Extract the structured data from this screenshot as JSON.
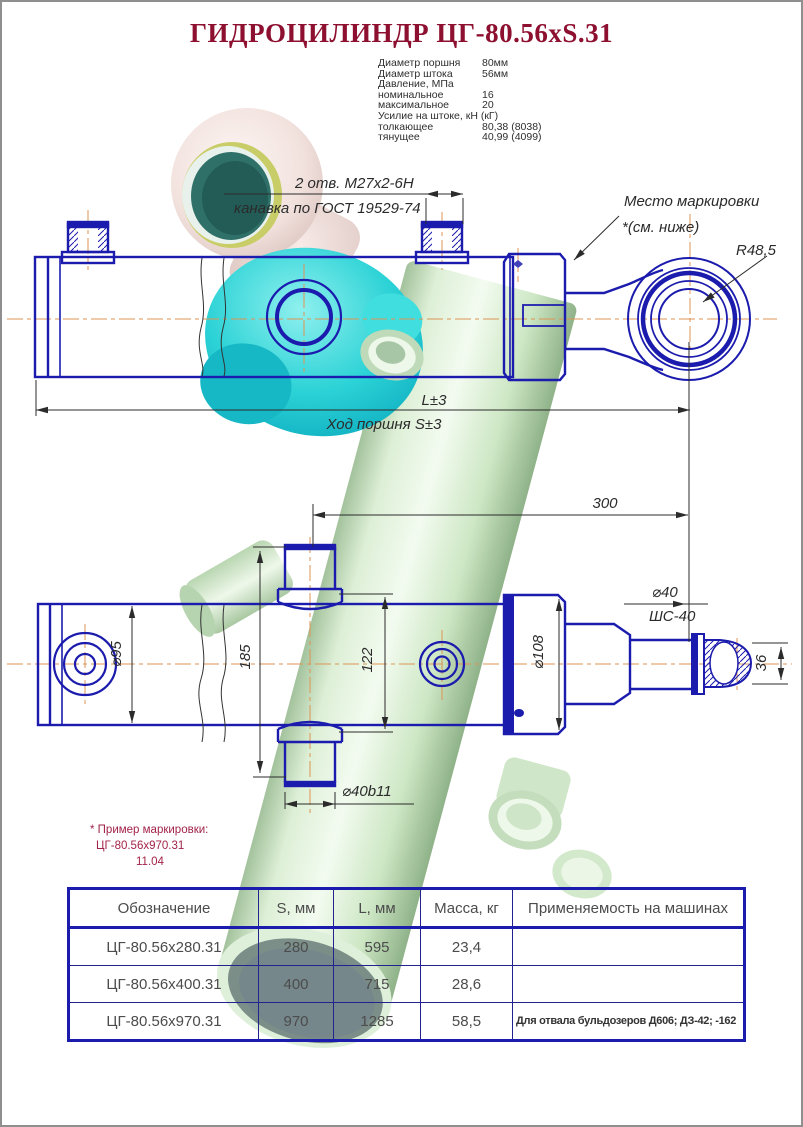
{
  "title": "ГИДРОЦИЛИНДР  ЦГ-80.56xS.31",
  "specs": {
    "rows": [
      {
        "label": "Диаметр поршня",
        "value": "80мм"
      },
      {
        "label": "Диаметр штока",
        "value": "56мм"
      },
      {
        "label": "Давление, МПа",
        "value": ""
      },
      {
        "label": "номинальное",
        "value": "16"
      },
      {
        "label": "максимальное",
        "value": "20"
      },
      {
        "label": "Усилие на штоке, кН (кГ)",
        "value": ""
      },
      {
        "label": "толкающее",
        "value": "80,38 (8038)"
      },
      {
        "label": "тянущее",
        "value": "40,99 (4099)"
      }
    ]
  },
  "annotations": {
    "holes": "2 отв. М27х2-6Н",
    "groove": "канавка по ГОСТ 19529-74",
    "marking_place": "Место маркировки",
    "marking_see_below": "*(см. ниже)",
    "radius": "R48,5",
    "length": "L±3",
    "stroke": "Ход поршня S±3",
    "dim_300": "300",
    "dia_95": "⌀95",
    "dim_185": "185",
    "dim_122": "122",
    "dia_108": "⌀108",
    "dia_40": "⌀40",
    "shs_40": "ШС-40",
    "dim_36": "36",
    "dia_40b11": "⌀40b11"
  },
  "note": {
    "line1": "* Пример маркировки:",
    "line2": "ЦГ-80.56x970.31",
    "line3": "11.04"
  },
  "table": {
    "headers": [
      "Обозначение",
      "S, мм",
      "L, мм",
      "Масса, кг",
      "Применяемость на машинах"
    ],
    "rows": [
      [
        "ЦГ-80.56x280.31",
        "280",
        "595",
        "23,4",
        ""
      ],
      [
        "ЦГ-80.56x400.31",
        "400",
        "715",
        "28,6",
        ""
      ],
      [
        "ЦГ-80.56x970.31",
        "970",
        "1285",
        "58,5",
        "Для отвала бульдозеров Д606; ДЗ-42; -162"
      ]
    ]
  },
  "colors": {
    "line_blue": "#1b1bad",
    "centerline_orange": "#dd9455",
    "dimension_black": "#2b2b2b",
    "title_maroon": "#8e1030",
    "note_crimson": "#a22349",
    "render_mint": "#d9efd2",
    "render_cyan": "#2bd2d6",
    "render_cream": "#f2e2de",
    "table_border_navy": "#1b1bad"
  }
}
